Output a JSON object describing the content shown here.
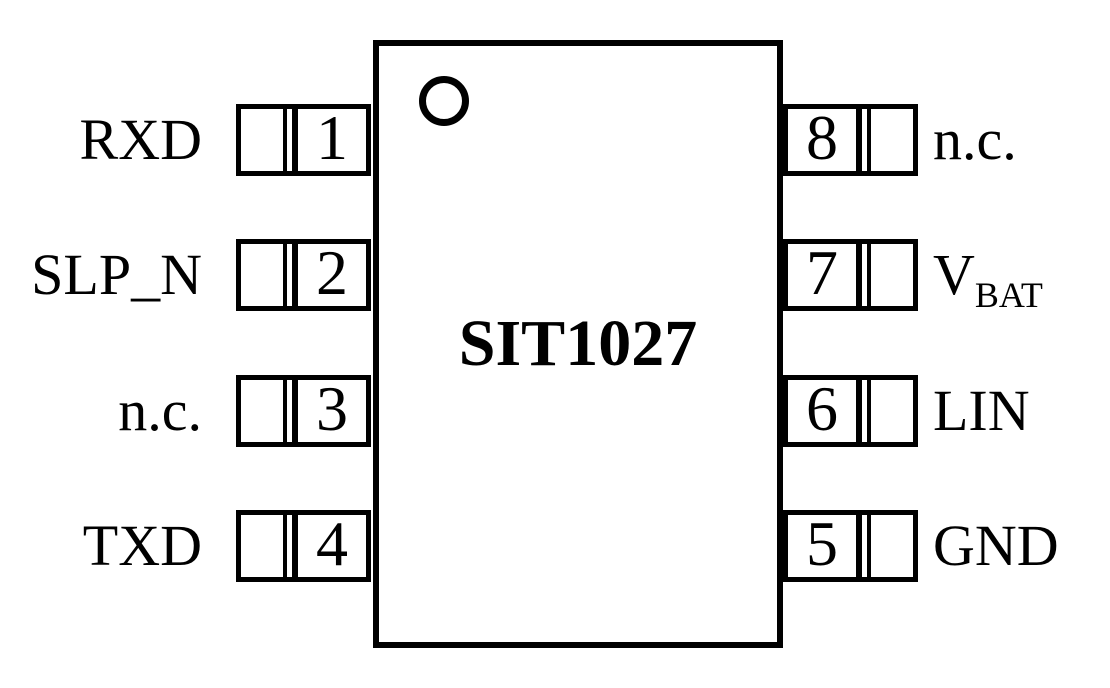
{
  "diagram": {
    "title": "SIT1027",
    "type": "ic-pinout",
    "package_pin_count": 8
  },
  "pins": {
    "left": [
      {
        "number": "1",
        "label": "RXD"
      },
      {
        "number": "2",
        "label": "SLP_N"
      },
      {
        "number": "3",
        "label": "n.c."
      },
      {
        "number": "4",
        "label": "TXD"
      }
    ],
    "right": [
      {
        "number": "8",
        "label": "n.c."
      },
      {
        "number": "7",
        "label": "V",
        "label_sub": "BAT"
      },
      {
        "number": "6",
        "label": "LIN"
      },
      {
        "number": "5",
        "label": "GND"
      }
    ]
  },
  "icons": {
    "pin1_indicator": "circle-icon"
  },
  "colors": {
    "line": "#000000",
    "background": "#ffffff",
    "text": "#000000"
  }
}
